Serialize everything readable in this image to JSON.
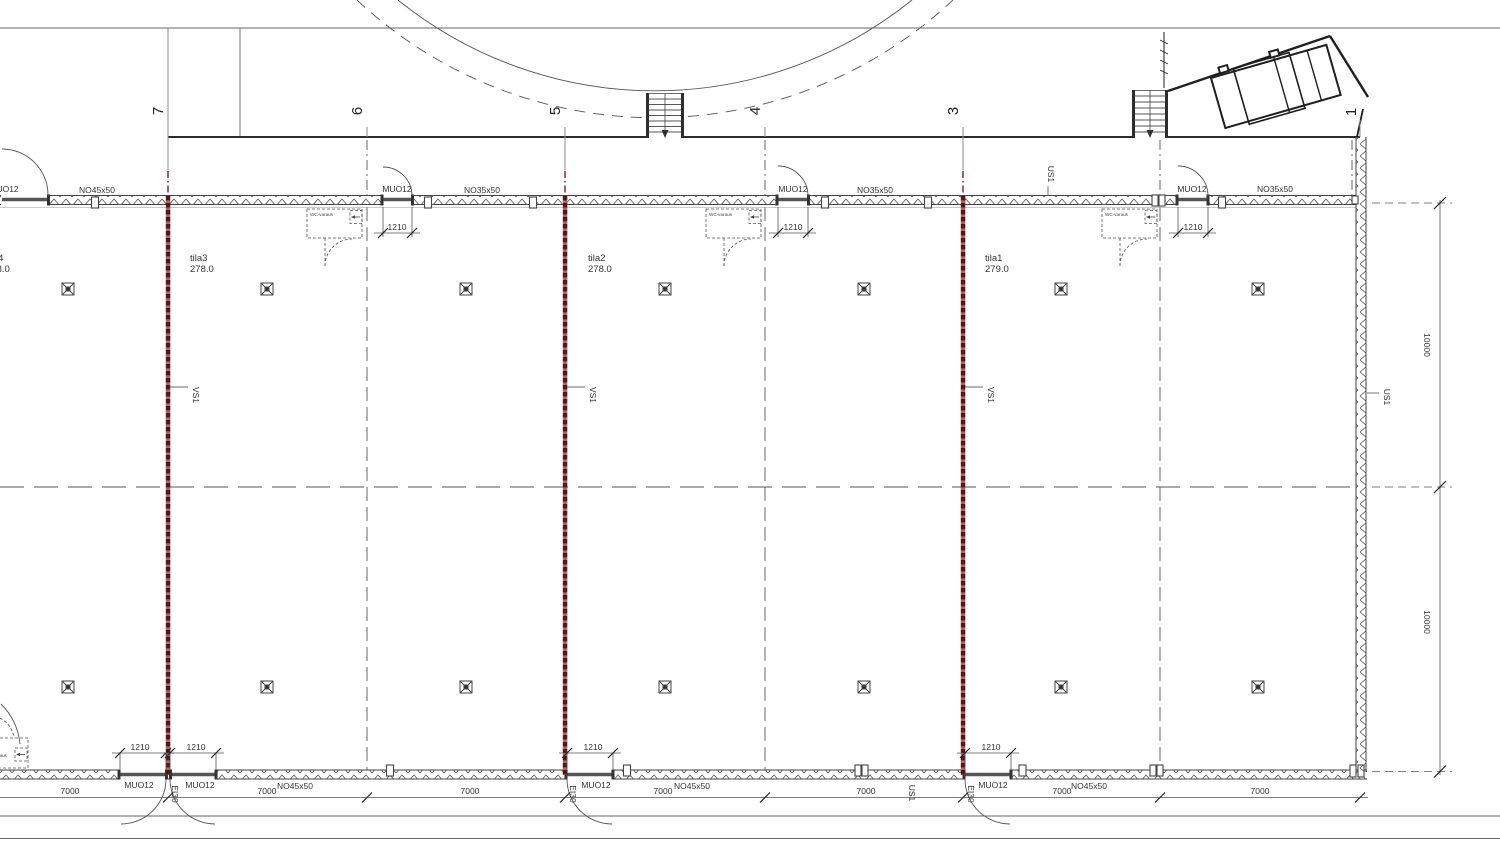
{
  "drawing": {
    "type": "floor-plan",
    "colors": {
      "line": "#3a3a3a",
      "fire_wall_dark": "#5a1414",
      "fire_wall_light": "#a46a6a",
      "background": "#ffffff"
    },
    "grids": {
      "labels": [
        "7",
        "6",
        "5",
        "4",
        "3",
        "2",
        "1"
      ]
    },
    "rooms": [
      {
        "label": "tila4",
        "area": "238.0"
      },
      {
        "label": "tila3",
        "area": "278.0"
      },
      {
        "label": "tila2",
        "area": "278.0"
      },
      {
        "label": "tila1",
        "area": "279.0"
      }
    ],
    "walls": {
      "top_labels": [
        "NO45x50",
        "NO35x50",
        "NO35x50",
        "NO35x50"
      ],
      "bottom_label": "NO45x50",
      "door_label": "MUO12",
      "exterior_wall_tag": "US1",
      "partition_wall_tag": "VS1",
      "fire_rating_tag": "EI30",
      "wc_reservation_label": "WC-varaus"
    },
    "dims": {
      "bay_width": "7000",
      "door_width": "1210",
      "bay_depth": "10000"
    }
  }
}
